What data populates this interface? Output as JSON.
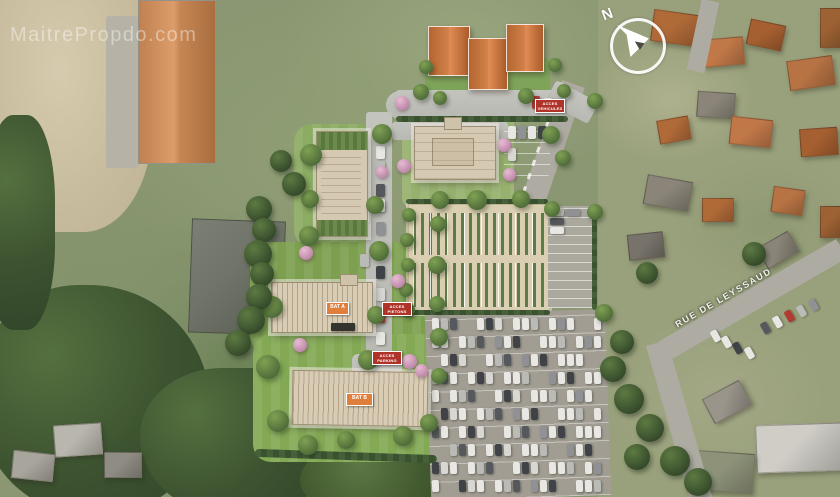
{
  "watermark": {
    "text": "MaitrePropdo.com"
  },
  "compass": {
    "north_label": "N"
  },
  "streets": {
    "rue_label": "RUE DE LEYSSAUD"
  },
  "site_plan": {
    "building_labels": [
      {
        "text": "BAT A"
      },
      {
        "text": "BAT B"
      }
    ],
    "signs": [
      {
        "line1": "ACCES",
        "line2": "VEHICULES"
      },
      {
        "line1": "ACCES",
        "line2": "PIETONS"
      },
      {
        "line1": "ACCES",
        "line2": "PARKING"
      }
    ],
    "colors": {
      "sign_red": "#b03329",
      "label_orange": "#e07f3c",
      "render_roof_beige": "#d9ccb5",
      "lawn_green": "#83a955",
      "meadow_green": "#8a9772",
      "road_gray": "#bcbcb7"
    }
  }
}
